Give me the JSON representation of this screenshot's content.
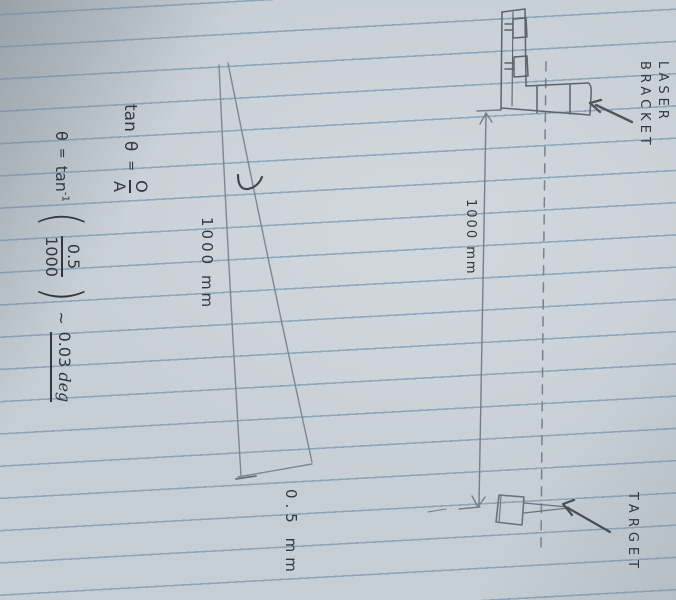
{
  "paper": {
    "type": "lined-notebook-photo",
    "paper_color": "#c6ced5",
    "rule_color": "#698caa",
    "ink_color": "#34373d",
    "pencil_color": "#7b818a"
  },
  "formulas": {
    "line1": {
      "fn": "tan",
      "theta": "θ",
      "eq": "=",
      "num": "O",
      "den": "A"
    },
    "line2": {
      "theta": "θ",
      "eq": "=",
      "fn": "tan",
      "sup": "-1",
      "open": "(",
      "num": "0.5",
      "den": "1000",
      "close": ")",
      "approx": "~",
      "result": "0.03",
      "unit": "deg"
    }
  },
  "labels": {
    "triangle_side": "1000 mm",
    "triangle_base": "0.5 mm",
    "dimension": "1000 mm",
    "laser_line1": "LASER",
    "laser_line2": "BRACKET",
    "target": "TARGET"
  }
}
